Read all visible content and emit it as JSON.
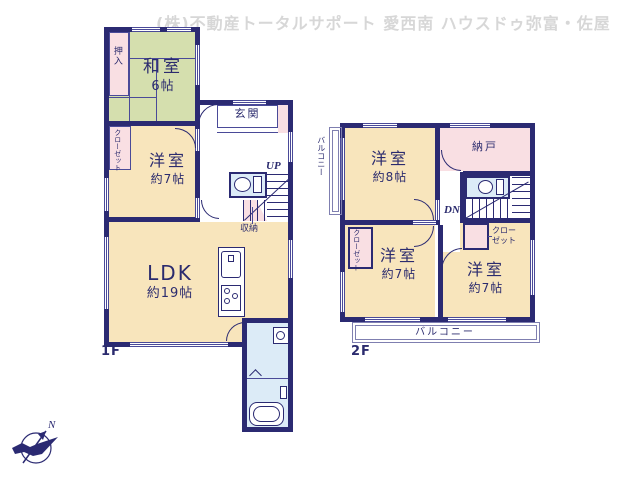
{
  "header": {
    "title": "(株)不動産トータルサポート 愛西南 ハウスドゥ弥富・佐屋"
  },
  "compass": {
    "north": "N"
  },
  "colors": {
    "wall": "#2b2a72",
    "cream": "#f8e5bc",
    "green": "#d5dfae",
    "pink": "#f9dfe3",
    "blue": "#dcebf7",
    "text": "#2b2b6e",
    "header_gray": "#d7d7d7"
  },
  "floor1": {
    "label": "1F",
    "washitsu": {
      "name": "和室",
      "size": "6帖"
    },
    "oshiire": "押入",
    "closet": "クローゼット",
    "yoshitsu": {
      "name": "洋室",
      "size": "約7帖"
    },
    "genkan": "玄関",
    "up": "UP",
    "shuno": "収納",
    "ldk": {
      "name": "LDK",
      "size": "約19帖"
    }
  },
  "floor2": {
    "label": "2F",
    "yoshitsu8": {
      "name": "洋室",
      "size": "約8帖"
    },
    "nando": "納戸",
    "dn": "DN",
    "closet_left": "クローゼット",
    "closet_right_lines": [
      "クロー",
      "ゼット"
    ],
    "yoshitsu7_left": {
      "name": "洋室",
      "size": "約7帖"
    },
    "yoshitsu7_right": {
      "name": "洋室",
      "size": "約7帖"
    },
    "balcony_side": "バルコニー",
    "balcony_bottom": "バルコニー"
  }
}
